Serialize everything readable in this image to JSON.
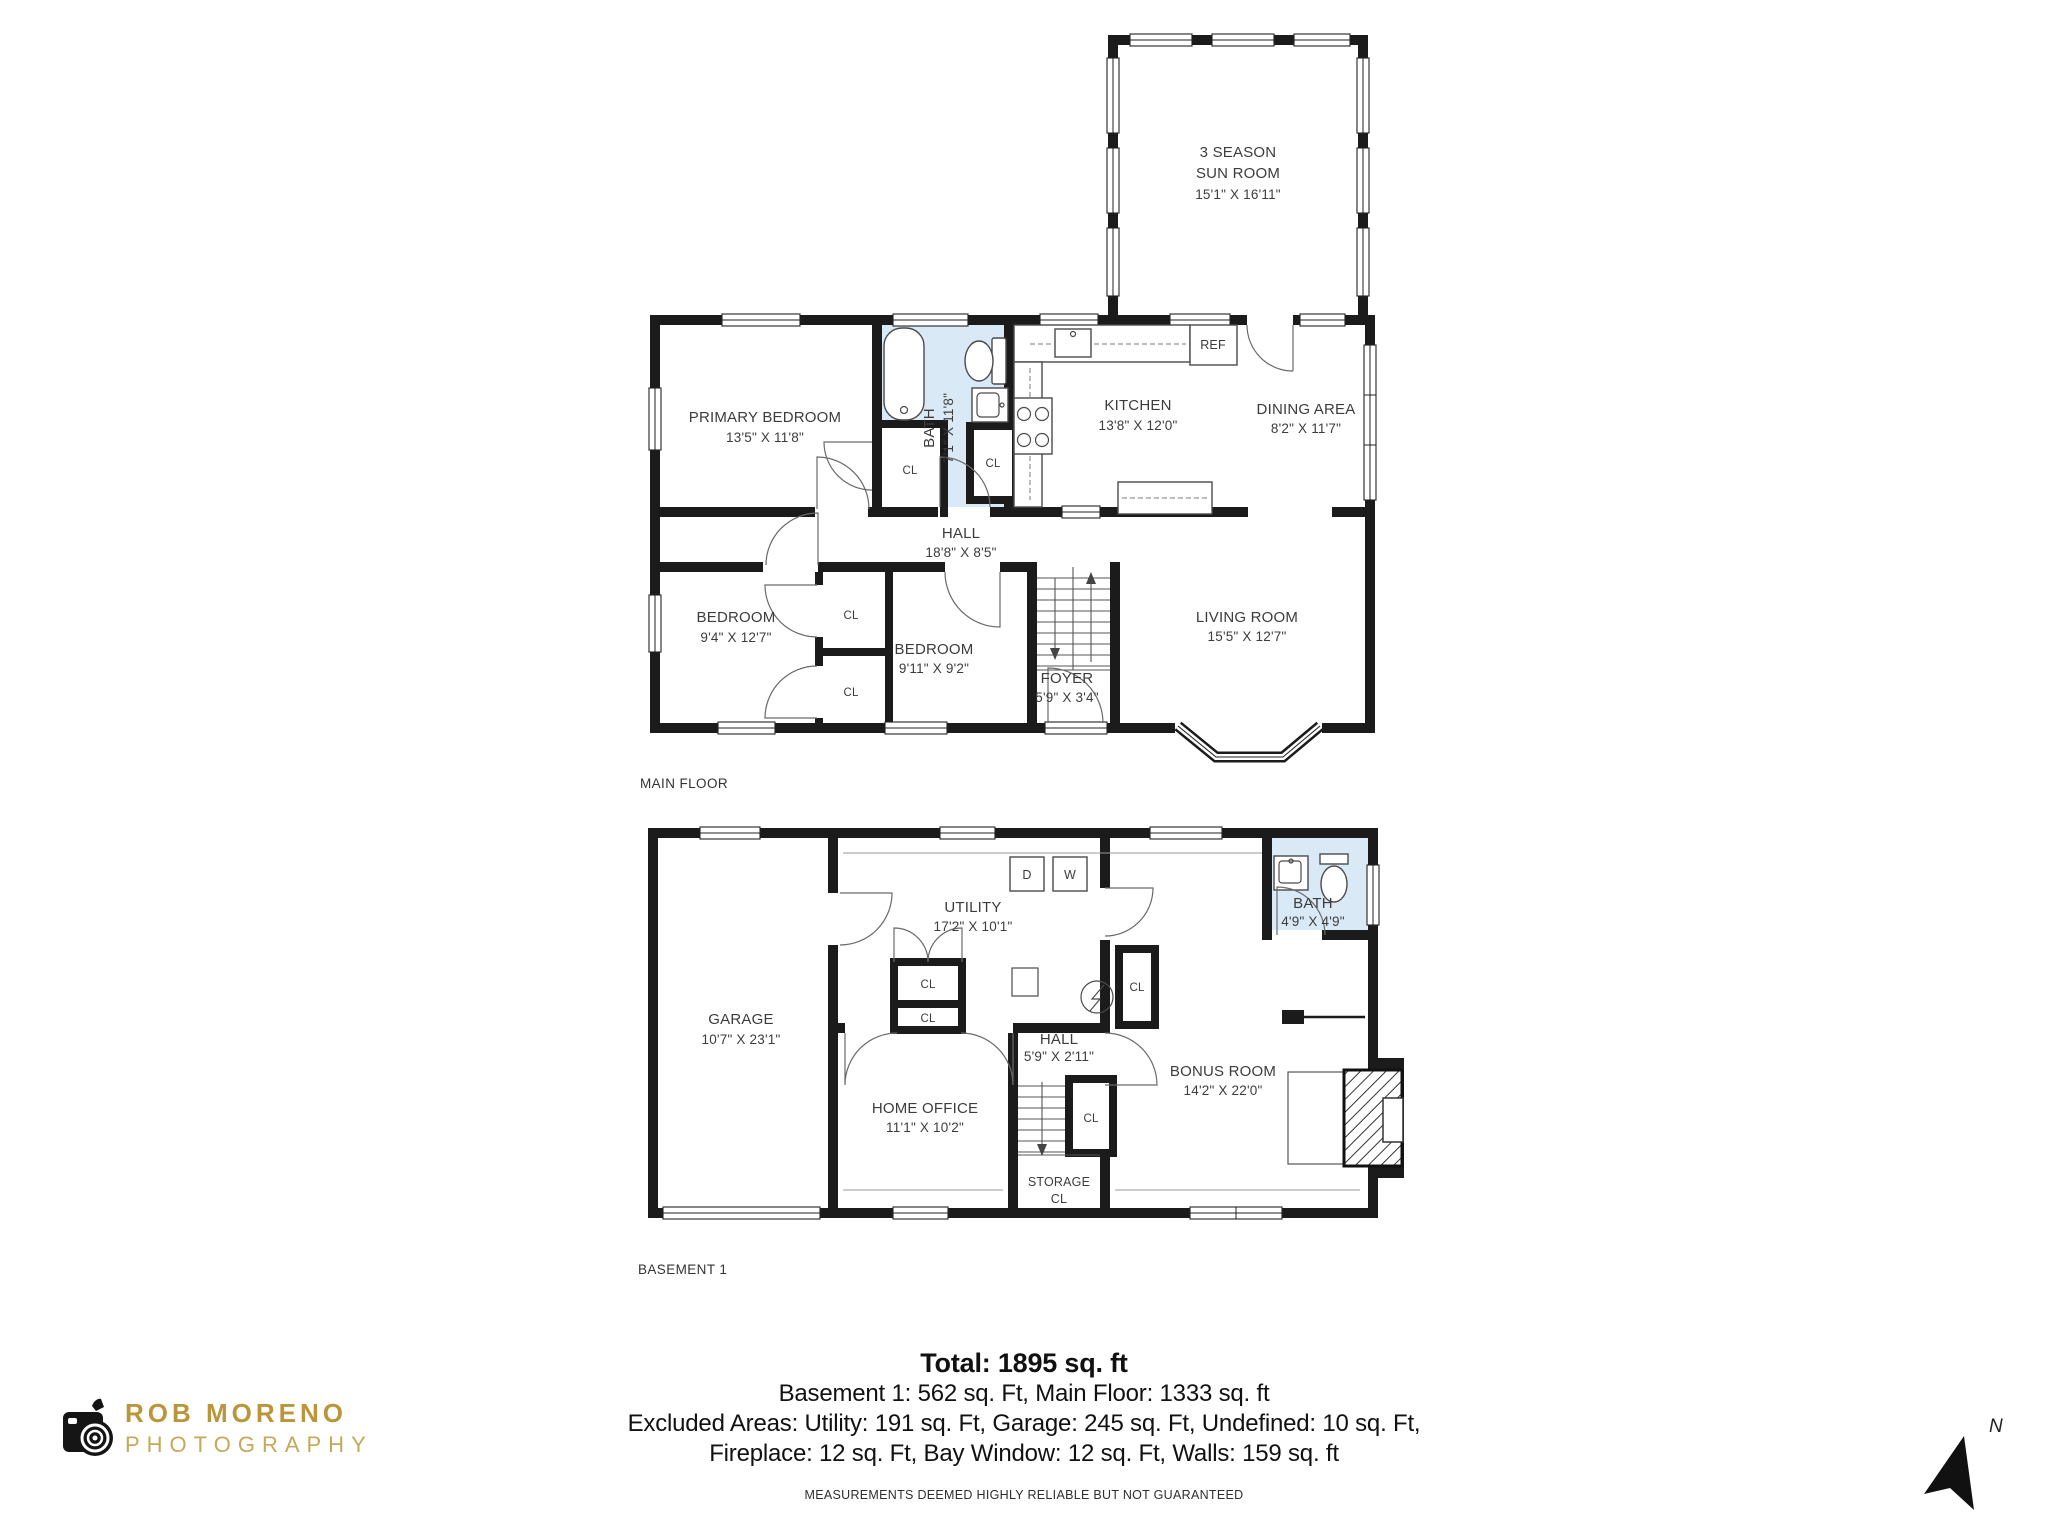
{
  "sun_room": {
    "name_line1": "3 SEASON",
    "name_line2": "SUN ROOM",
    "dims": "15'1\" X 16'11\""
  },
  "main_floor": {
    "caption": "MAIN FLOOR",
    "primary_bedroom": {
      "name": "PRIMARY BEDROOM",
      "dims": "13'5\" X 11'8\""
    },
    "bath": {
      "name": "BATH",
      "dims": "7'1\" X 11'8\""
    },
    "kitchen": {
      "name": "KITCHEN",
      "dims": "13'8\" X 12'0\""
    },
    "dining": {
      "name": "DINING AREA",
      "dims": "8'2\" X 11'7\""
    },
    "hall": {
      "name": "HALL",
      "dims": "18'8\" X 8'5\""
    },
    "bedroom_left": {
      "name": "BEDROOM",
      "dims": "9'4\" X 12'7\""
    },
    "bedroom_mid": {
      "name": "BEDROOM",
      "dims": "9'11\" X 9'2\""
    },
    "foyer": {
      "name": "FOYER",
      "dims": "5'9\" X 3'4\""
    },
    "living": {
      "name": "LIVING ROOM",
      "dims": "15'5\" X 12'7\""
    },
    "fridge": "REF"
  },
  "basement": {
    "caption": "BASEMENT 1",
    "garage": {
      "name": "GARAGE",
      "dims": "10'7\" X 23'1\""
    },
    "utility": {
      "name": "UTILITY",
      "dims": "17'2\" X 10'1\""
    },
    "bath": {
      "name": "BATH",
      "dims": "4'9\" X 4'9\""
    },
    "hall": {
      "name": "HALL",
      "dims": "5'9\" X 2'11\""
    },
    "home_office": {
      "name": "HOME OFFICE",
      "dims": "11'1\" X 10'2\""
    },
    "bonus": {
      "name": "BONUS ROOM",
      "dims": "14'2\" X 22'0\""
    },
    "storage_line1": "STORAGE",
    "storage_line2": "CL",
    "dryer": "D",
    "washer": "W"
  },
  "closet": "CL",
  "summary": {
    "total": "Total: 1895 sq. ft",
    "line2": "Basement 1: 562 sq. Ft, Main Floor: 1333 sq. ft",
    "line3": "Excluded Areas: Utility: 191 sq. Ft, Garage: 245 sq. Ft, Undefined: 10 sq. Ft,",
    "line4": "Fireplace: 12 sq. Ft, Bay Window: 12 sq. Ft, Walls: 159 sq. ft",
    "disclaimer": "MEASUREMENTS DEEMED HIGHLY RELIABLE BUT NOT GUARANTEED"
  },
  "branding": {
    "studio": "ROB MORENO",
    "tagline": "PHOTOGRAPHY"
  },
  "compass": {
    "label": "N"
  },
  "colors": {
    "wall": "#1b1b1b",
    "bath_fill": "#d9eaf6",
    "brand_gold": "#bb953a",
    "brand_gold_light": "#c5a958"
  }
}
